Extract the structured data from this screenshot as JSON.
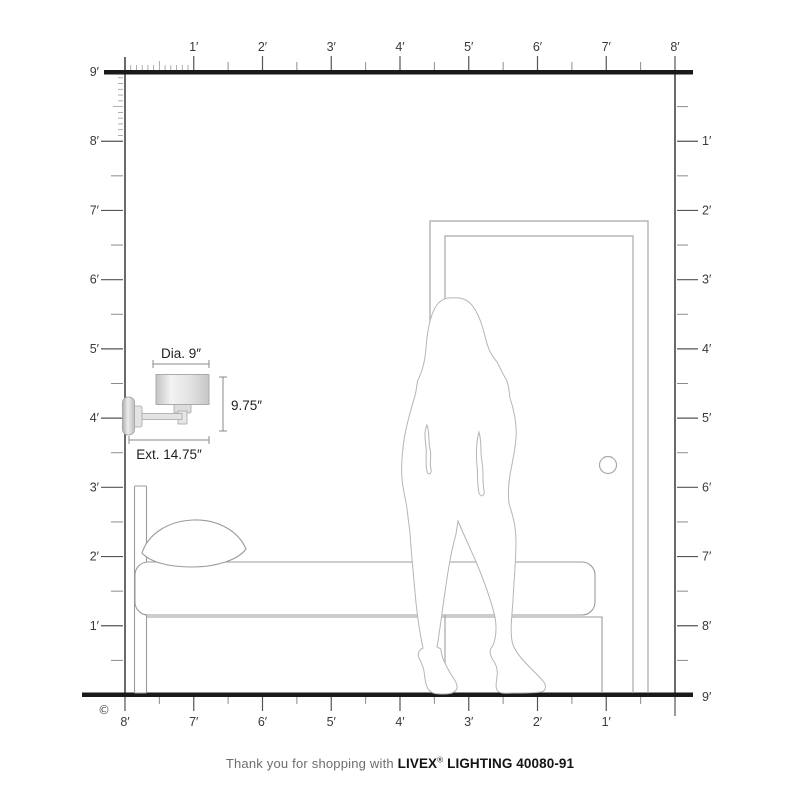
{
  "diagram": {
    "rulers": {
      "top": {
        "labels": [
          "1′",
          "2′",
          "3′",
          "4′",
          "5′",
          "6′",
          "7′",
          "8′"
        ]
      },
      "left": {
        "labels": [
          "9′",
          "8′",
          "7′",
          "6′",
          "5′",
          "4′",
          "3′",
          "2′",
          "1′"
        ]
      },
      "right": {
        "labels": [
          "1′",
          "2′",
          "3′",
          "4′",
          "5′",
          "6′",
          "7′",
          "8′",
          "9′"
        ]
      },
      "bottom": {
        "labels": [
          "8′",
          "7′",
          "6′",
          "5′",
          "4′",
          "3′",
          "2′",
          "1′"
        ]
      }
    },
    "lamp_dimensions": {
      "diameter": "Dia. 9″",
      "height": "9.75″",
      "extension": "Ext. 14.75″"
    },
    "copyright_symbol": "©"
  },
  "footer": {
    "prefix": "Thank you for shopping with ",
    "brand": "LIVEX",
    "registered": "®",
    "product": " LIGHTING 40080-91"
  }
}
